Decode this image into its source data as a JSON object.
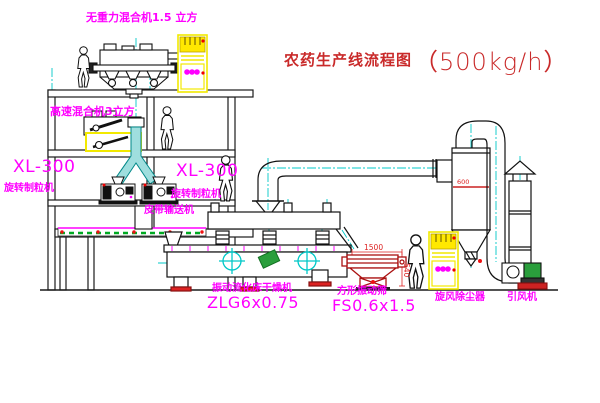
{
  "title": {
    "text": "农药生产线流程图",
    "capacity": "（500kg/h）"
  },
  "labels": {
    "gravity_mixer": "无重力混合机1.5 立方",
    "high_speed_mixer": "高速混合机3立方",
    "granulator_left_model": "XL-300",
    "granulator_left_name": "旋转制粒机",
    "granulator_right_model": "XL-300",
    "granulator_right_name": "旋转制粒机",
    "belt_conveyor": "皮带输送机",
    "dryer_name": "振动流化床干燥机",
    "dryer_model": "ZLG6x0.75",
    "sieve_name": "方形振动筛",
    "sieve_model": "FS0.6x1.5",
    "cyclone": "旋风除尘器",
    "fan": "引风机"
  },
  "dimensions": {
    "sieve_length": "1500",
    "sieve_height": "540",
    "cyclone_size": "600"
  },
  "colors": {
    "label_magenta": "#ff00ff",
    "title_red": "#c92a2a",
    "dimension_red": "#dd2222",
    "highlight_yellow": "#f2e900",
    "centerline_cyan": "#00c8c8",
    "accent_green": "#2a9e3c",
    "accent_red": "#ee1111"
  }
}
